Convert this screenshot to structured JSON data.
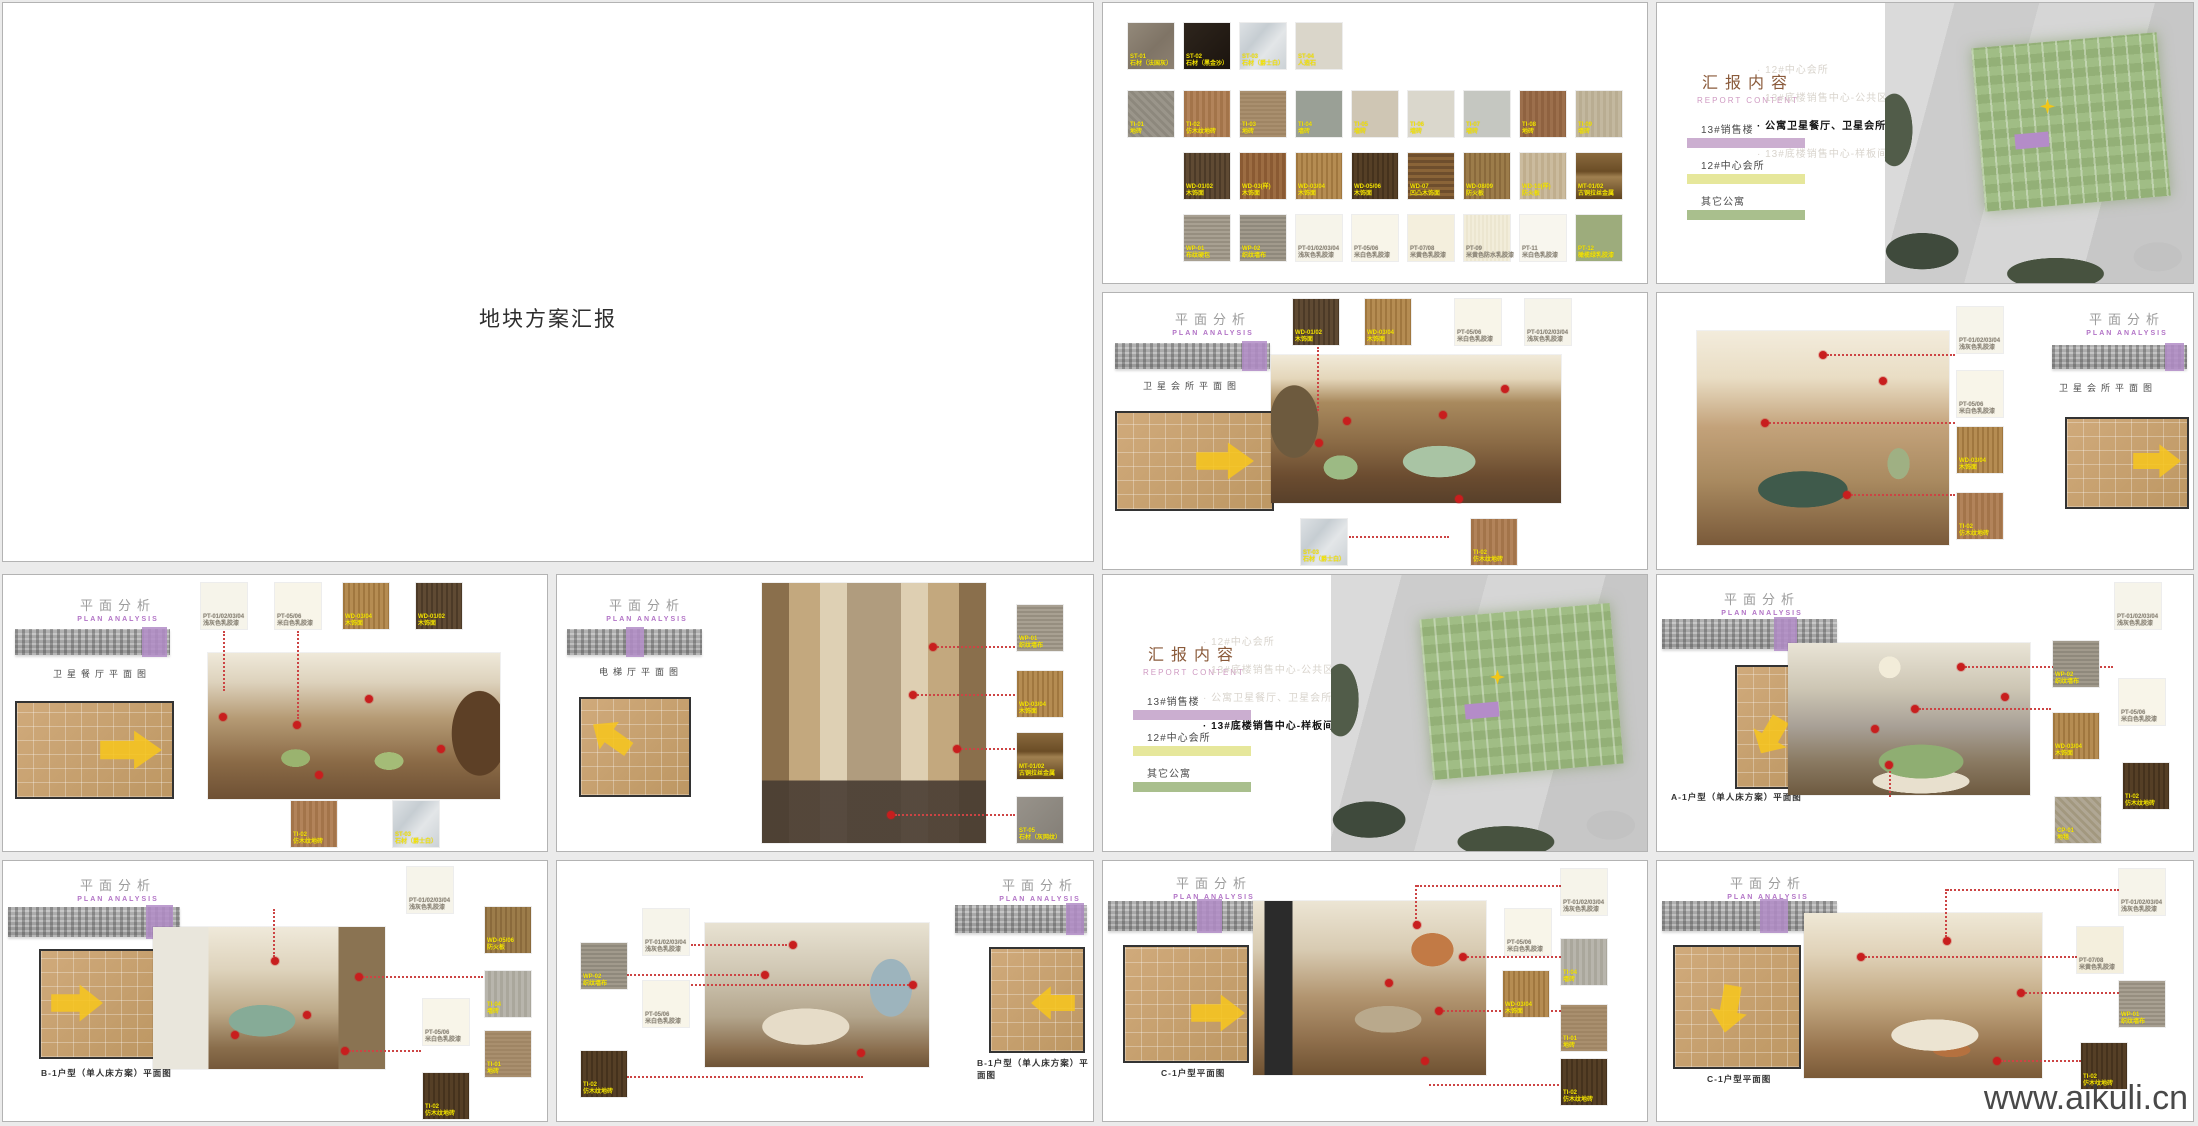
{
  "page": {
    "watermark": "www.aikuli.cn"
  },
  "labels": {
    "plan_analysis_cn": "平面分析",
    "plan_analysis_en": "PLAN ANALYSIS",
    "report_content_cn": "汇报内容",
    "report_content_en": "REPORT CONTENT"
  },
  "title_slide": {
    "title": "地块方案汇报"
  },
  "materials": {
    "rows": [
      {
        "items": [
          {
            "code": "ST-01",
            "name": "石材（法国灰）",
            "sw": "background:linear-gradient(135deg,#93897a,#7f7466 55%,#8d8172)",
            "lb": "color:#f5e400"
          },
          {
            "code": "ST-02",
            "name": "石材（黑金沙）",
            "sw": "background:linear-gradient(135deg,#2e251d,#1b140e)",
            "lb": "color:#f5e400"
          },
          {
            "code": "ST-03",
            "name": "石材（爵士白）",
            "sw": "background:linear-gradient(130deg,#dde1e4,#c6cdd2 35%,#e3e6e8 60%,#ccd2d6)",
            "lb": "color:#f5e400"
          },
          {
            "code": "ST-04",
            "name": "人造石",
            "sw": "background:#dad6ca",
            "lb": "color:#f5e400"
          }
        ]
      },
      {
        "items": [
          {
            "code": "TI-01",
            "name": "地砖",
            "sw": "background:repeating-linear-gradient(45deg,#9a958a 0 3px,#8d887d 3px 6px)",
            "lb": "color:#f5e400"
          },
          {
            "code": "TI-02",
            "name": "仿木纹地砖",
            "sw": "background:repeating-linear-gradient(90deg,#a3744a 0 3px,#b2835a 3px 6px)",
            "lb": "color:#f5e400"
          },
          {
            "code": "TI-03",
            "name": "地砖",
            "sw": "background:repeating-linear-gradient(0deg,#a98f6e 0 2px,#9f8564 2px 4px)",
            "lb": "color:#f5e400"
          },
          {
            "code": "TI-04",
            "name": "墙砖",
            "sw": "background:#9aa096",
            "lb": "color:#f5e400"
          },
          {
            "code": "TI-05",
            "name": "墙砖",
            "sw": "background:#cfc6b4",
            "lb": "color:#f5e400"
          },
          {
            "code": "TI-06",
            "name": "墙砖",
            "sw": "background:#dad7cc",
            "lb": "color:#f5e400"
          },
          {
            "code": "TI-07",
            "name": "墙砖",
            "sw": "background:#c5c7c1",
            "lb": "color:#f5e400"
          },
          {
            "code": "TI-08",
            "name": "地砖",
            "sw": "background:repeating-linear-gradient(90deg,#9c6f4c 0 3px,#8f6240 3px 6px)",
            "lb": "color:#f5e400"
          },
          {
            "code": "TI-09",
            "name": "墙砖",
            "sw": "background:repeating-linear-gradient(90deg,#c3b89f 0 3px,#b9ad92 3px 6px)",
            "lb": "color:#f5e400"
          }
        ]
      },
      {
        "items": [
          {
            "code": "WD-01/02",
            "name": "木饰面",
            "sw": "background:repeating-linear-gradient(90deg,#4c3a27 0 2px,#5f4a33 2px 5px)",
            "lb": "color:#f5e400"
          },
          {
            "code": "WD-03(样)",
            "name": "木饰面",
            "sw": "background:repeating-linear-gradient(90deg,#8a5a33 0 3px,#9c6c42 3px 6px)",
            "lb": "color:#f5e400"
          },
          {
            "code": "WD-03/04",
            "name": "木饰面",
            "sw": "background:repeating-linear-gradient(90deg,#a0773f 0 2px,#b58c52 2px 5px)",
            "lb": "color:#f5e400"
          },
          {
            "code": "WD-05/06",
            "name": "木饰面",
            "sw": "background:repeating-linear-gradient(90deg,#45321d 0 2px,#553f26 2px 5px)",
            "lb": "color:#f5e400"
          },
          {
            "code": "WD-07",
            "name": "凹凸木饰面",
            "sw": "background:repeating-linear-gradient(0deg,#6e4e2d 0 3px,#8a6438 3px 6px)",
            "lb": "color:#f5e400"
          },
          {
            "code": "WD-08/09",
            "name": "防火板",
            "sw": "background:repeating-linear-gradient(90deg,#8a6a3c 0 2px,#9c7c4a 2px 5px)",
            "lb": "color:#f5e400"
          },
          {
            "code": "WD-10(样)",
            "name": "防火板",
            "sw": "background:repeating-linear-gradient(90deg,#cbbb9e 0 3px,#c0ae8e 3px 6px)",
            "lb": "color:#f5e400"
          },
          {
            "code": "MT-01/02",
            "name": "古铜拉丝金属",
            "sw": "background:linear-gradient(180deg,#8a6a3e 0%,#6b4d26 40%,#a08050 52%,#5f4420 100%)",
            "lb": "color:#f5e400"
          }
        ]
      },
      {
        "items": [
          {
            "code": "WP-01",
            "name": "布纹硬包",
            "sw": "background:repeating-linear-gradient(0deg,#a8a092 0 2px,#968e80 2px 4px)",
            "lb": "color:#f5e400"
          },
          {
            "code": "WP-02",
            "name": "织纹墙布",
            "sw": "background:repeating-linear-gradient(0deg,#a19a8c 0 2px,#8f897c 2px 4px)",
            "lb": "color:#f5e400"
          },
          {
            "code": "PT-01/02/03/04",
            "name": "浅灰色乳胶漆",
            "sw": "background:#f6f4ea",
            "lb": "color:#8a8375"
          },
          {
            "code": "PT-05/06",
            "name": "米白色乳胶漆",
            "sw": "background:#f8f5e9",
            "lb": "color:#8a8375"
          },
          {
            "code": "PT-07/08",
            "name": "米黄色乳胶漆",
            "sw": "background:#f4efdd",
            "lb": "color:#8a8375"
          },
          {
            "code": "PT-09",
            "name": "米黄色防水乳胶漆",
            "sw": "background:repeating-linear-gradient(90deg,#f2edda 0 2px,#ece6d0 2px 4px)",
            "lb": "color:#8a8375"
          },
          {
            "code": "PT-11",
            "name": "米白色乳胶漆",
            "sw": "background:#f8f6ee",
            "lb": "color:#8a8375"
          },
          {
            "code": "PT-12",
            "name": "橄榄绿乳胶漆",
            "sw": "background:#9dac7c",
            "lb": "color:#f5e400"
          }
        ]
      }
    ]
  },
  "siteplan": {
    "legend": [
      {
        "label": "13#销售楼",
        "bar": "background:#cbaed0"
      },
      {
        "label": "12#中心会所",
        "bar": "background:#e6e79b"
      },
      {
        "label": "其它公寓",
        "bar": "background:#a9bf8d"
      }
    ],
    "bullets": [
      "12#中心会所",
      "13#底楼销售中心-公共区",
      "公寓卫星餐厅、卫星会所",
      "13#底楼销售中心-样板间"
    ]
  },
  "slides": {
    "lounge": {
      "caption": "卫星会所平面图",
      "callouts": [
        {
          "code": "WD-01/02",
          "name": "木饰面",
          "sw": "background:repeating-linear-gradient(90deg,#4c3a27 0 2px,#5f4a33 2px 5px)",
          "lb": "color:#f5e400"
        },
        {
          "code": "WD-03/04",
          "name": "木饰面",
          "sw": "background:repeating-linear-gradient(90deg,#a0773f 0 2px,#b58c52 2px 5px)",
          "lb": "color:#f5e400"
        },
        {
          "code": "PT-05/06",
          "name": "米白色乳胶漆",
          "sw": "background:#f8f5e9",
          "lb": "color:#8a8375"
        },
        {
          "code": "PT-01/02/03/04",
          "name": "浅灰色乳胶漆",
          "sw": "background:#f6f4ea",
          "lb": "color:#8a8375"
        },
        {
          "code": "ST-03",
          "name": "石材（爵士白）",
          "sw": "background:linear-gradient(130deg,#dde1e4,#c6cdd2 35%,#e3e6e8 60%,#ccd2d6)",
          "lb": "color:#f5e400"
        },
        {
          "code": "TI-02",
          "name": "仿木纹地砖",
          "sw": "background:repeating-linear-gradient(90deg,#a3744a 0 3px,#b2835a 3px 6px)",
          "lb": "color:#f5e400"
        }
      ]
    },
    "billiards": {
      "caption": "卫星会所平面图",
      "callouts": [
        {
          "code": "PT-01/02/03/04",
          "name": "浅灰色乳胶漆",
          "sw": "background:#f6f4ea",
          "lb": "color:#8a8375"
        },
        {
          "code": "PT-05/06",
          "name": "米白色乳胶漆",
          "sw": "background:#f8f5e9",
          "lb": "color:#8a8375"
        },
        {
          "code": "WD-03/04",
          "name": "木饰面",
          "sw": "background:repeating-linear-gradient(90deg,#a0773f 0 2px,#b58c52 2px 5px)",
          "lb": "color:#f5e400"
        },
        {
          "code": "TI-02",
          "name": "仿木纹地砖",
          "sw": "background:repeating-linear-gradient(90deg,#a3744a 0 3px,#b2835a 3px 6px)",
          "lb": "color:#f5e400"
        }
      ]
    },
    "dining": {
      "caption": "卫星餐厅平面图",
      "callouts": [
        {
          "code": "PT-01/02/03/04",
          "name": "浅灰色乳胶漆",
          "sw": "background:#f6f4ea",
          "lb": "color:#8a8375"
        },
        {
          "code": "PT-05/06",
          "name": "米白色乳胶漆",
          "sw": "background:#f8f5e9",
          "lb": "color:#8a8375"
        },
        {
          "code": "WD-03/04",
          "name": "木饰面",
          "sw": "background:repeating-linear-gradient(90deg,#a0773f 0 2px,#b58c52 2px 5px)",
          "lb": "color:#f5e400"
        },
        {
          "code": "WD-01/02",
          "name": "木饰面",
          "sw": "background:repeating-linear-gradient(90deg,#4c3a27 0 2px,#5f4a33 2px 5px)",
          "lb": "color:#f5e400"
        },
        {
          "code": "TI-02",
          "name": "仿木纹地砖",
          "sw": "background:repeating-linear-gradient(90deg,#a3744a 0 3px,#b2835a 3px 6px)",
          "lb": "color:#f5e400"
        },
        {
          "code": "ST-03",
          "name": "石材（爵士白）",
          "sw": "background:linear-gradient(130deg,#dde1e4,#c6cdd2 35%,#e3e6e8 60%,#ccd2d6)",
          "lb": "color:#f5e400"
        }
      ]
    },
    "elevator": {
      "caption": "电梯厅平面图",
      "callouts": [
        {
          "code": "WP-01",
          "name": "织纹墙布",
          "sw": "background:repeating-linear-gradient(0deg,#a8a092 0 2px,#968e80 2px 4px)",
          "lb": "color:#f5e400"
        },
        {
          "code": "WD-03/04",
          "name": "木饰面",
          "sw": "background:repeating-linear-gradient(90deg,#a0773f 0 2px,#b58c52 2px 5px)",
          "lb": "color:#f5e400"
        },
        {
          "code": "MT-01/02",
          "name": "古铜拉丝金属",
          "sw": "background:linear-gradient(180deg,#8a6a3e 0%,#6b4d26 40%,#a08050 52%,#5f4420 100%)",
          "lb": "color:#f5e400"
        },
        {
          "code": "ST-05",
          "name": "石材（灰网纹）",
          "sw": "background:linear-gradient(135deg,#98938b,#837e76)",
          "lb": "color:#f5e400"
        }
      ]
    },
    "bedroom_a1": {
      "caption": "A-1户型（单人床方案）平面图",
      "callouts": [
        {
          "code": "PT-01/02/03/04",
          "name": "浅灰色乳胶漆",
          "sw": "background:#f6f4ea",
          "lb": "color:#8a8375"
        },
        {
          "code": "WP-02",
          "name": "织纹墙布",
          "sw": "background:repeating-linear-gradient(0deg,#a19a8c 0 2px,#8f897c 2px 4px)",
          "lb": "color:#f5e400"
        },
        {
          "code": "PT-05/06",
          "name": "米白色乳胶漆",
          "sw": "background:#f8f5e9",
          "lb": "color:#8a8375"
        },
        {
          "code": "WD-03/04",
          "name": "木饰面",
          "sw": "background:repeating-linear-gradient(90deg,#a0773f 0 2px,#b58c52 2px 5px)",
          "lb": "color:#f5e400"
        },
        {
          "code": "TI-02",
          "name": "仿木纹地砖",
          "sw": "background:repeating-linear-gradient(90deg,#45321d 0 2px,#553f26 2px 5px)",
          "lb": "color:#f5e400"
        },
        {
          "code": "CP-01",
          "name": "地毯",
          "sw": "background:repeating-linear-gradient(45deg,#b0a794 0 3px,#a2987f 3px 6px)",
          "lb": "color:#f5e400"
        }
      ]
    },
    "living_b1": {
      "caption": "B-1户型（单人床方案）平面图",
      "callouts": [
        {
          "code": "PT-01/02/03/04",
          "name": "浅灰色乳胶漆",
          "sw": "background:#f6f4ea",
          "lb": "color:#8a8375"
        },
        {
          "code": "WD-05/06",
          "name": "防火板",
          "sw": "background:repeating-linear-gradient(90deg,#8a6a3c 0 2px,#9c7c4a 2px 5px)",
          "lb": "color:#f5e400"
        },
        {
          "code": "TI-04",
          "name": "墙砖",
          "sw": "background:repeating-linear-gradient(90deg,#b8b5ac 0 3px,#aaa79c 3px 6px)",
          "lb": "color:#f5e400"
        },
        {
          "code": "PT-05/06",
          "name": "米白色乳胶漆",
          "sw": "background:#f8f5e9",
          "lb": "color:#8a8375"
        },
        {
          "code": "TI-01",
          "name": "地砖",
          "sw": "background:repeating-linear-gradient(0deg,#a98f6e 0 2px,#9f8564 2px 4px)",
          "lb": "color:#f5e400"
        },
        {
          "code": "TI-02",
          "name": "仿木纹地砖",
          "sw": "background:repeating-linear-gradient(90deg,#45321d 0 2px,#553f26 2px 5px)",
          "lb": "color:#f5e400"
        }
      ]
    },
    "bedroom_b1": {
      "caption": "B-1户型（单人床方案）平面图",
      "callouts": [
        {
          "code": "PT-01/02/03/04",
          "name": "浅灰色乳胶漆",
          "sw": "background:#f6f4ea",
          "lb": "color:#8a8375"
        },
        {
          "code": "WP-02",
          "name": "织纹墙布",
          "sw": "background:repeating-linear-gradient(0deg,#a19a8c 0 2px,#8f897c 2px 4px)",
          "lb": "color:#f5e400"
        },
        {
          "code": "PT-05/06",
          "name": "米白色乳胶漆",
          "sw": "background:#f8f5e9",
          "lb": "color:#8a8375"
        },
        {
          "code": "TI-02",
          "name": "仿木纹地砖",
          "sw": "background:repeating-linear-gradient(90deg,#45321d 0 2px,#553f26 2px 5px)",
          "lb": "color:#f5e400"
        }
      ]
    },
    "living_c1": {
      "caption": "C-1户型平面图",
      "callouts": [
        {
          "code": "PT-01/02/03/04",
          "name": "浅灰色乳胶漆",
          "sw": "background:#f6f4ea",
          "lb": "color:#8a8375"
        },
        {
          "code": "PT-05/06",
          "name": "米白色乳胶漆",
          "sw": "background:#f8f5e9",
          "lb": "color:#8a8375"
        },
        {
          "code": "TI-04",
          "name": "墙砖",
          "sw": "background:repeating-linear-gradient(90deg,#b8b5ac 0 3px,#aaa79c 3px 6px)",
          "lb": "color:#f5e400"
        },
        {
          "code": "WD-03/04",
          "name": "木饰面",
          "sw": "background:repeating-linear-gradient(90deg,#a0773f 0 2px,#b58c52 2px 5px)",
          "lb": "color:#f5e400"
        },
        {
          "code": "TI-01",
          "name": "地砖",
          "sw": "background:repeating-linear-gradient(0deg,#a98f6e 0 2px,#9f8564 2px 4px)",
          "lb": "color:#f5e400"
        },
        {
          "code": "TI-02",
          "name": "仿木纹地砖",
          "sw": "background:repeating-linear-gradient(90deg,#45321d 0 2px,#553f26 2px 5px)",
          "lb": "color:#f5e400"
        }
      ]
    },
    "bedroom_c1": {
      "caption": "C-1户型平面图",
      "callouts": [
        {
          "code": "PT-01/02/03/04",
          "name": "浅灰色乳胶漆",
          "sw": "background:#f6f4ea",
          "lb": "color:#8a8375"
        },
        {
          "code": "PT-07/08",
          "name": "米黄色乳胶漆",
          "sw": "background:#f4efdd",
          "lb": "color:#8a8375"
        },
        {
          "code": "WP-01",
          "name": "织纹墙布",
          "sw": "background:repeating-linear-gradient(0deg,#a8a092 0 2px,#968e80 2px 4px)",
          "lb": "color:#f5e400"
        },
        {
          "code": "TI-02",
          "name": "仿木纹地砖",
          "sw": "background:repeating-linear-gradient(90deg,#45321d 0 2px,#553f26 2px 5px)",
          "lb": "color:#f5e400"
        }
      ]
    }
  }
}
